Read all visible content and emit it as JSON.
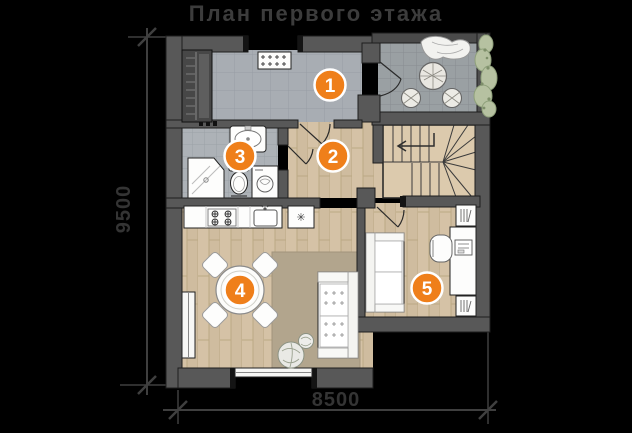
{
  "title": "План первого этажа",
  "dimensions": {
    "height_label": "9500",
    "width_label": "8500"
  },
  "markers": [
    {
      "number": "1"
    },
    {
      "number": "2"
    },
    {
      "number": "3"
    },
    {
      "number": "4"
    },
    {
      "number": "5"
    }
  ],
  "colors": {
    "background": "#000000",
    "marker_orange": "#ef7f1a",
    "wall_gray": "#585858",
    "entry_tile": "#a8adb3",
    "terrace_tile": "#9aa0a3",
    "bath_tile": "#adb2b7",
    "wood_floor": "#d5c2a6",
    "rug": "#b2a58d",
    "plant_green": "#b6c1a1",
    "dimension_text": "#343434",
    "title_text": "#3c3c3c"
  }
}
